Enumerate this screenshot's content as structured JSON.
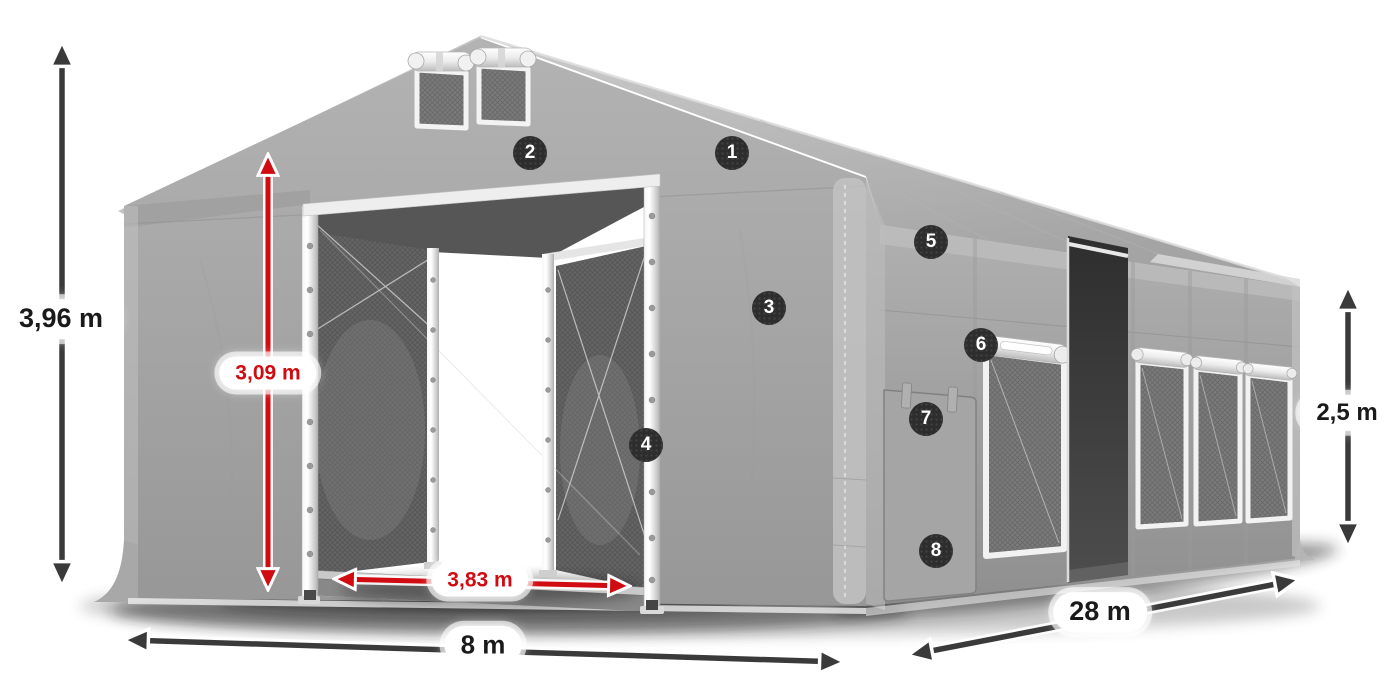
{
  "diagram": {
    "subject": "tent-dimension-diagram",
    "dimension_labels": {
      "total_height": "3,96 m",
      "door_height": "3,09 m",
      "door_width": "3,83 m",
      "front_width": "8 m",
      "side_length": "28 m",
      "side_wall_height": "2,5 m"
    },
    "callout_numbers": [
      "1",
      "2",
      "3",
      "4",
      "5",
      "6",
      "7",
      "8"
    ],
    "colors": {
      "background": "#ffffff",
      "dimension_red": "#d00b11",
      "dimension_dark": "#3a3a3a",
      "pill_background": "#ffffff",
      "pill_text": "#1a1a1a",
      "badge_background": "#2d2d2d",
      "badge_text": "#ffffff",
      "tent_gray": "#a6a6a6",
      "frame_white": "#f2f2f2"
    }
  }
}
